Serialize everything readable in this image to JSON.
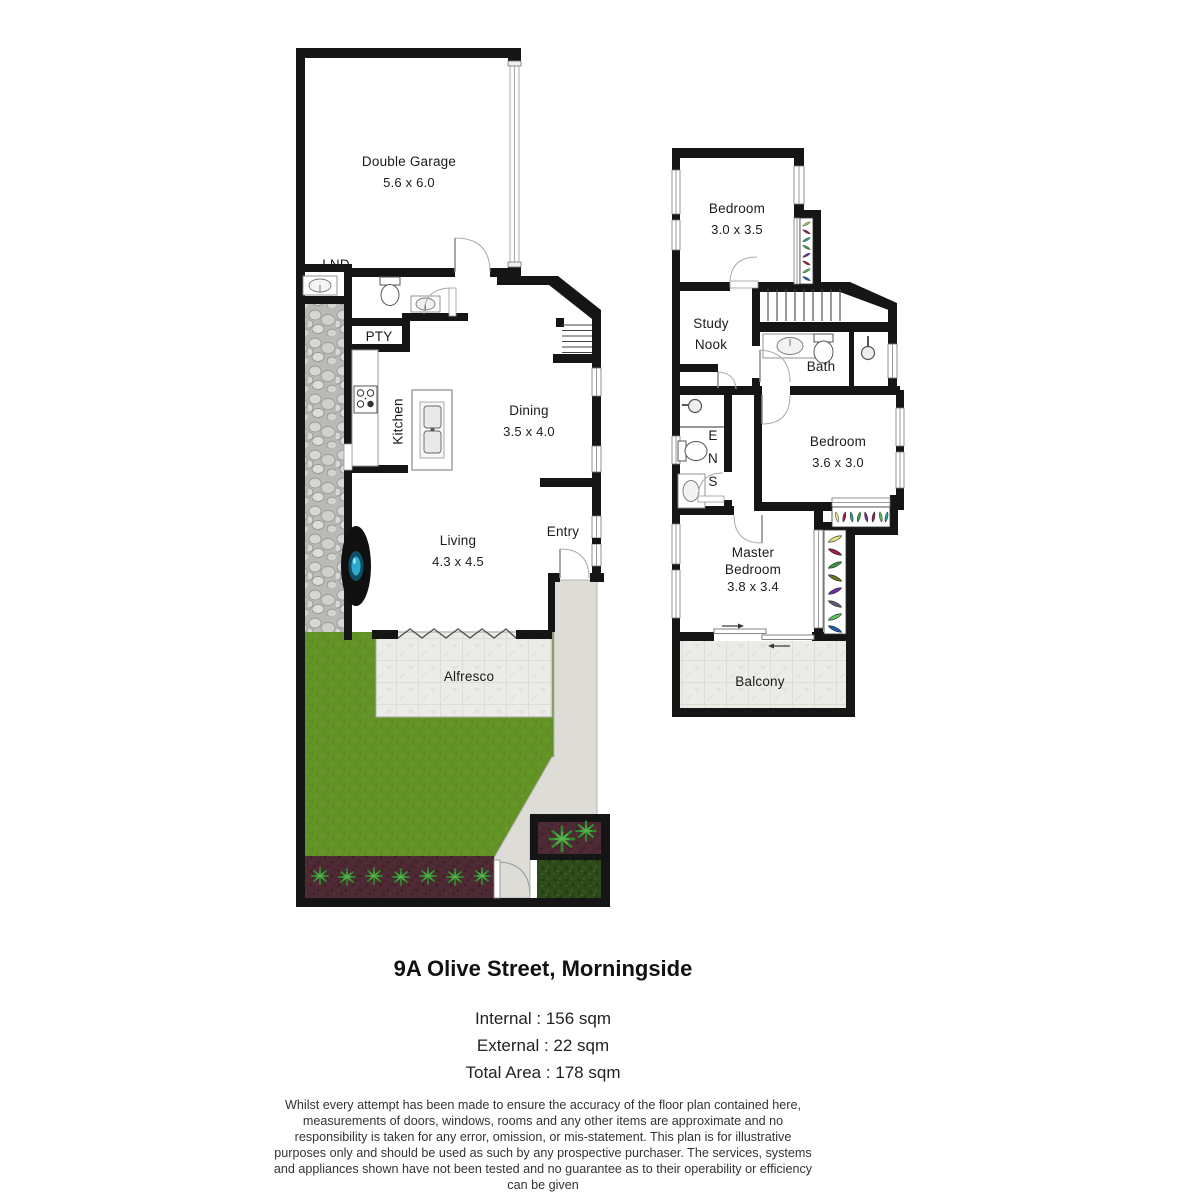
{
  "title_block": {
    "address": "9A Olive Street, Morningside",
    "internal": "Internal : 156 sqm",
    "external": "External : 22 sqm",
    "total": "Total Area : 178 sqm",
    "disclaimer": "Whilst every attempt has been made to ensure the accuracy of the floor plan contained here, measurements of doors, windows, rooms and any other items are approximate and no responsibility is taken for any error, omission, or mis-statement. This plan is for illustrative purposes only and should be used as such by any prospective purchaser. The services, systems and appliances shown have not been tested and no guarantee as to their operability or efficiency can be given"
  },
  "ground_floor": {
    "garage": {
      "name": "Double Garage",
      "dims": "5.6 x 6.0"
    },
    "laundry_label": "LND",
    "pantry_label": "PTY",
    "kitchen_label": "Kitchen",
    "dining": {
      "name": "Dining",
      "dims": "3.5 x 4.0"
    },
    "living": {
      "name": "Living",
      "dims": "4.3 x 4.5"
    },
    "entry_label": "Entry",
    "alfresco_label": "Alfresco"
  },
  "upper_floor": {
    "bedroom_front": {
      "name": "Bedroom",
      "dims": "3.0 x 3.5"
    },
    "study_nook": {
      "line1": "Study",
      "line2": "Nook"
    },
    "bath_label": "Bath",
    "ensuite": {
      "l1": "E",
      "l2": "N",
      "l3": "S"
    },
    "bedroom_mid": {
      "name": "Bedroom",
      "dims": "3.6 x 3.0"
    },
    "master_bedroom": {
      "line1": "Master",
      "line2": "Bedroom",
      "dims": "3.8 x 3.4"
    },
    "balcony_label": "Balcony"
  },
  "icons": {
    "toilet-icon": "ellipse+tank shape",
    "basin-icon": "oval in bench",
    "shower-icon": "circle with arm",
    "stove-icon": "square with 4 burners",
    "double-sink-icon": "two rounded tubs",
    "laundry-tub-icon": "oval tub",
    "water-tank-icon": "black oval with blue core",
    "stairs-icon": "parallel treads",
    "door-swing-icon": "quarter arc",
    "sliding-door-icon": "offset rails with arrows",
    "bifold-door-icon": "zigzag",
    "plant-icon": "green asterisk",
    "gate-icon": "quarter arc in fence"
  },
  "colors": {
    "wall": "#151515",
    "lawn": "#639327",
    "garden_soil": "#4d2a33",
    "hedge": "#2e4a1a",
    "stone_path": "#bfbfbd",
    "paving": "#dedcd6",
    "tiles": "#ebebe8",
    "water_tank": "#2fa8cf",
    "planter_palette": [
      "#e8e87a",
      "#a02040",
      "#2a9d8f",
      "#3f9b3f",
      "#7030a0",
      "#6b7a1e",
      "#55c855",
      "#2060b0"
    ]
  }
}
